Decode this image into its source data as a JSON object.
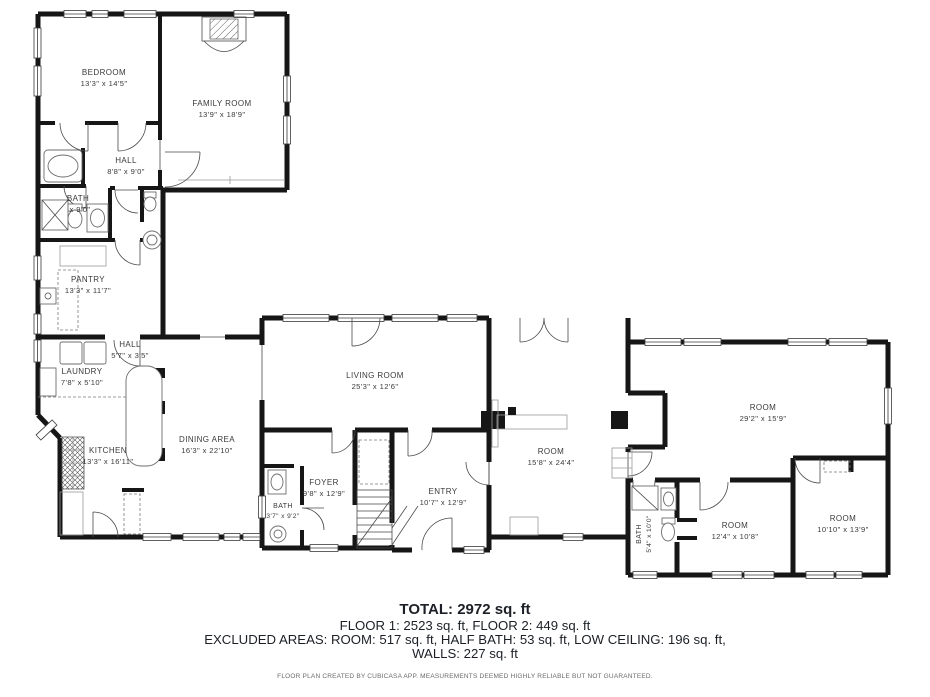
{
  "floorplan": {
    "rooms": [
      {
        "name": "BEDROOM",
        "dims": "13'3\" x 14'5\""
      },
      {
        "name": "FAMILY ROOM",
        "dims": "13'9\" x 18'9\""
      },
      {
        "name": "HALL",
        "dims": "8'8\" x 9'0\""
      },
      {
        "name": "BATH",
        "dims": "x 9'0\""
      },
      {
        "name": "PANTRY",
        "dims": "13'3\" x 11'7\""
      },
      {
        "name": "HALL",
        "dims": "5'7\" x 3'5\""
      },
      {
        "name": "LAUNDRY",
        "dims": "7'8\" x 5'10\""
      },
      {
        "name": "KITCHEN",
        "dims": "13'3\" x 16'11\""
      },
      {
        "name": "DINING AREA",
        "dims": "16'3\" x 22'10\""
      },
      {
        "name": "LIVING ROOM",
        "dims": "25'3\" x 12'6\""
      },
      {
        "name": "FOYER",
        "dims": "9'8\" x 12'9\""
      },
      {
        "name": "BATH",
        "dims": "3'7\" x 9'2\""
      },
      {
        "name": "ENTRY",
        "dims": "10'7\" x 12'9\""
      },
      {
        "name": "ROOM",
        "dims": "15'8\" x 24'4\""
      },
      {
        "name": "ROOM",
        "dims": "29'2\" x 15'9\""
      },
      {
        "name": "BATH",
        "dims": "5'4\" x 10'0\""
      },
      {
        "name": "ROOM",
        "dims": "12'4\" x 10'8\""
      },
      {
        "name": "ROOM",
        "dims": "10'10\" x 13'9\""
      }
    ],
    "summary": {
      "total": "TOTAL: 2972 sq. ft",
      "floors": "FLOOR 1: 2523 sq. ft, FLOOR 2: 449 sq. ft",
      "excluded": "EXCLUDED AREAS: ROOM: 517 sq. ft, HALF BATH: 53 sq. ft, LOW CEILING: 196 sq. ft,",
      "walls": "WALLS: 227 sq. ft",
      "disclaimer": "FLOOR PLAN CREATED BY CUBICASA APP. MEASUREMENTS DEEMED HIGHLY RELIABLE BUT NOT GUARANTEED."
    },
    "colors": {
      "wall": "#161616",
      "label": "#3a3a3a",
      "background": "#ffffff"
    }
  }
}
